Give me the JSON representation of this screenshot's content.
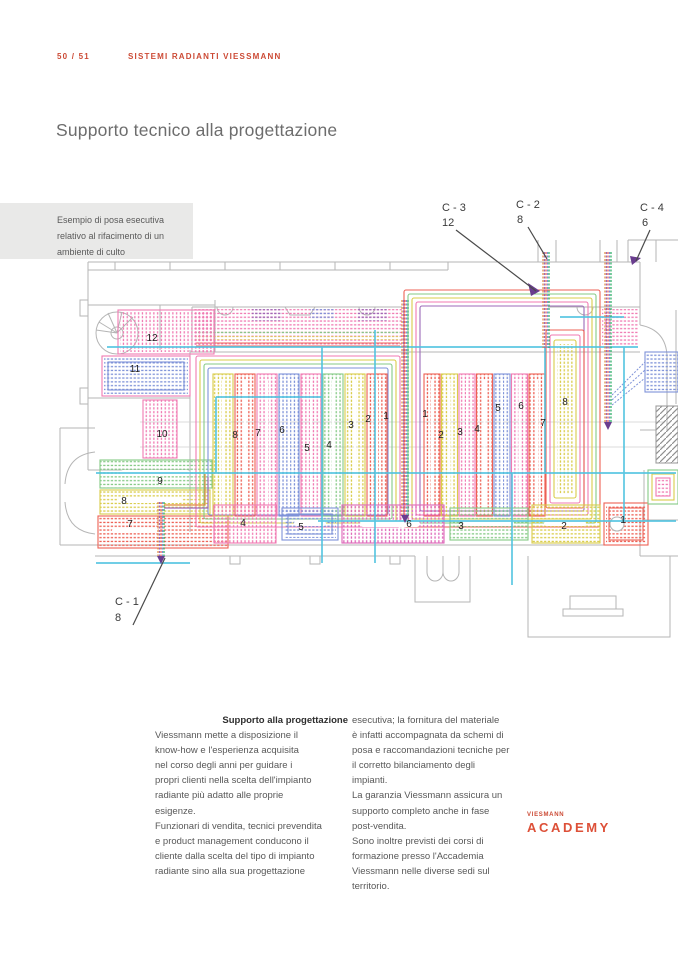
{
  "page": {
    "number": "50 / 51",
    "section": "SISTEMI RADIANTI VIESSMANN",
    "title": "Supporto tecnico alla progettazione"
  },
  "caption": {
    "lines": [
      "Esempio di posa esecutiva",
      "relativo al rifacimento di un",
      "ambiente di culto"
    ]
  },
  "plan": {
    "connectors": [
      {
        "name": "C - 3",
        "count": "12"
      },
      {
        "name": "C - 2",
        "count": "8"
      },
      {
        "name": "C - 4",
        "count": "6"
      },
      {
        "name": "C - 1",
        "count": "8"
      }
    ],
    "zone_labels": [
      "12",
      "11",
      "10",
      "9",
      "8",
      "7",
      "8",
      "7",
      "6",
      "5",
      "4",
      "3",
      "2",
      "1",
      "1",
      "2",
      "3",
      "4",
      "5",
      "6",
      "7",
      "8",
      "4",
      "5",
      "6",
      "3",
      "2",
      "1"
    ],
    "colors": {
      "accent": "#cc4a35",
      "cyan_trunk": "#4fc3e0",
      "pink": "#f07ab2",
      "red": "#ed6054",
      "yellow": "#d9cc4a",
      "green": "#85c985",
      "blue": "#7e92d8",
      "magenta": "#dd66b8",
      "purple": "#9c6ab8",
      "orange": "#e08a3c",
      "outline_gray": "#b5b5b5"
    }
  },
  "support": {
    "heading": "Supporto alla progettazione",
    "col1": [
      "Viessmann mette a disposizione il",
      "know-how e l'esperienza acquisita",
      "nel corso degli anni per guidare i",
      "propri clienti nella scelta dell'impianto",
      "radiante più adatto alle proprie",
      "esigenze.",
      "Funzionari di vendita, tecnici prevendita",
      "e product management conducono il",
      "cliente dalla scelta del tipo di impianto",
      "radiante sino alla sua progettazione"
    ],
    "col2": [
      "esecutiva; la fornitura del materiale",
      "è infatti accompagnata da schemi di",
      "posa e raccomandazioni tecniche per",
      "il corretto bilanciamento degli impianti.",
      "La garanzia Viessmann assicura un",
      "supporto completo anche in fase",
      "post-vendita.",
      "Sono inoltre previsti dei corsi di",
      "formazione presso l'Accademia",
      "Viessmann nelle diverse sedi sul",
      "territorio."
    ]
  },
  "academy": {
    "brand": "VIESMANN",
    "name": "ACADEMY"
  }
}
